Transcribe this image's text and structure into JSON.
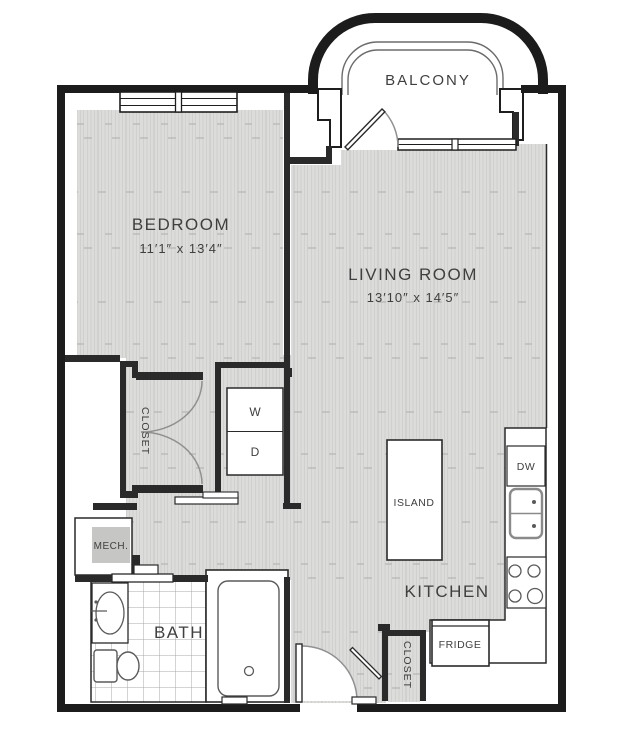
{
  "title": "apartment-floor-plan",
  "rooms": {
    "balcony": {
      "label": "BALCONY"
    },
    "bedroom": {
      "label": "BEDROOM",
      "dims": "11′1″ x 13′4″"
    },
    "living_room": {
      "label": "LIVING ROOM",
      "dims": "13′10″ x 14′5″"
    },
    "bedroom_closet": {
      "label": "CLOSET"
    },
    "entry_closet": {
      "label": "CLOSET"
    },
    "mech": {
      "label": "MECH."
    },
    "bath": {
      "label": "BATH"
    },
    "kitchen": {
      "label": "KITCHEN"
    }
  },
  "fixtures": {
    "washer": {
      "label": "W"
    },
    "dryer": {
      "label": "D"
    },
    "island": {
      "label": "ISLAND"
    },
    "dishwasher": {
      "label": "DW"
    },
    "fridge": {
      "label": "FRIDGE"
    }
  },
  "colors": {
    "wall": "#1e1e1e",
    "interior_wall": "#2a2a2a",
    "floor_base": "#dcdcda",
    "floor_stripe": "#cdcdcb",
    "tile_line": "#a9a9a9",
    "mech_fill": "#c6c6c5",
    "fixture_line": "#5a5a5a",
    "door_arc": "#909090",
    "text": "#3f3f3f"
  }
}
